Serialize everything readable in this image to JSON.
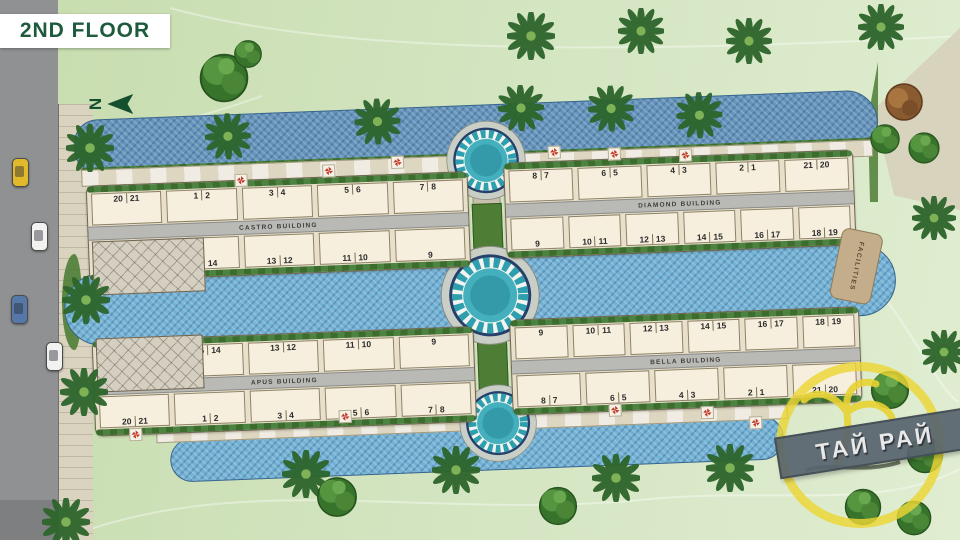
{
  "header": {
    "title": "2ND FLOOR"
  },
  "compass": {
    "label": "N"
  },
  "buildings": [
    {
      "name": "CASTRO BUILDING",
      "top": [
        [
          "20",
          "21"
        ],
        [
          "1",
          "2"
        ],
        [
          "3",
          "4"
        ],
        [
          "5",
          "6"
        ],
        [
          "7",
          "8"
        ]
      ],
      "bottom": [
        [
          "17",
          "16"
        ],
        [
          "15",
          "14"
        ],
        [
          "13",
          "12"
        ],
        [
          "11",
          "10"
        ],
        [
          "9"
        ]
      ]
    },
    {
      "name": "DIAMOND BUILDING",
      "top": [
        [
          "8",
          "7"
        ],
        [
          "6",
          "5"
        ],
        [
          "4",
          "3"
        ],
        [
          "2",
          "1"
        ],
        [
          "21",
          "20"
        ]
      ],
      "bottom": [
        [
          "9"
        ],
        [
          "10",
          "11"
        ],
        [
          "12",
          "13"
        ],
        [
          "14",
          "15"
        ],
        [
          "16",
          "17"
        ],
        [
          "18",
          "19"
        ]
      ]
    },
    {
      "name": "APUS BUILDING",
      "top": [
        [
          "17",
          "16"
        ],
        [
          "15",
          "14"
        ],
        [
          "13",
          "12"
        ],
        [
          "11",
          "10"
        ],
        [
          "9"
        ]
      ],
      "bottom": [
        [
          "20",
          "21"
        ],
        [
          "1",
          "2"
        ],
        [
          "3",
          "4"
        ],
        [
          "5",
          "6"
        ],
        [
          "7",
          "8"
        ]
      ]
    },
    {
      "name": "BELLA BUILDING",
      "top": [
        [
          "9"
        ],
        [
          "10",
          "11"
        ],
        [
          "12",
          "13"
        ],
        [
          "14",
          "15"
        ],
        [
          "16",
          "17"
        ],
        [
          "18",
          "19"
        ]
      ],
      "bottom": [
        [
          "8",
          "7"
        ],
        [
          "6",
          "5"
        ],
        [
          "4",
          "3"
        ],
        [
          "2",
          "1"
        ],
        [
          "21",
          "20"
        ]
      ]
    }
  ],
  "facilities": {
    "label": "FACILITIES"
  },
  "watermark": {
    "text": "ТАЙ РАЙ"
  },
  "cars": [
    {
      "color": "#e3b92c"
    },
    {
      "color": "#f2f2f0"
    },
    {
      "color": "#5578a8"
    },
    {
      "color": "#f2f2f0"
    }
  ],
  "colors": {
    "header_text": "#1e5b3c",
    "lawn": "#cfe2b8",
    "pool_dark": "#6493bb",
    "pool_light": "#72b2d6",
    "hedge_green": "#3c6c2e",
    "building_cream": "#f6efdd",
    "accent_red": "#c23727",
    "logo_yellow": "#ebd534",
    "mosaic_teal": "#2e9fae"
  }
}
